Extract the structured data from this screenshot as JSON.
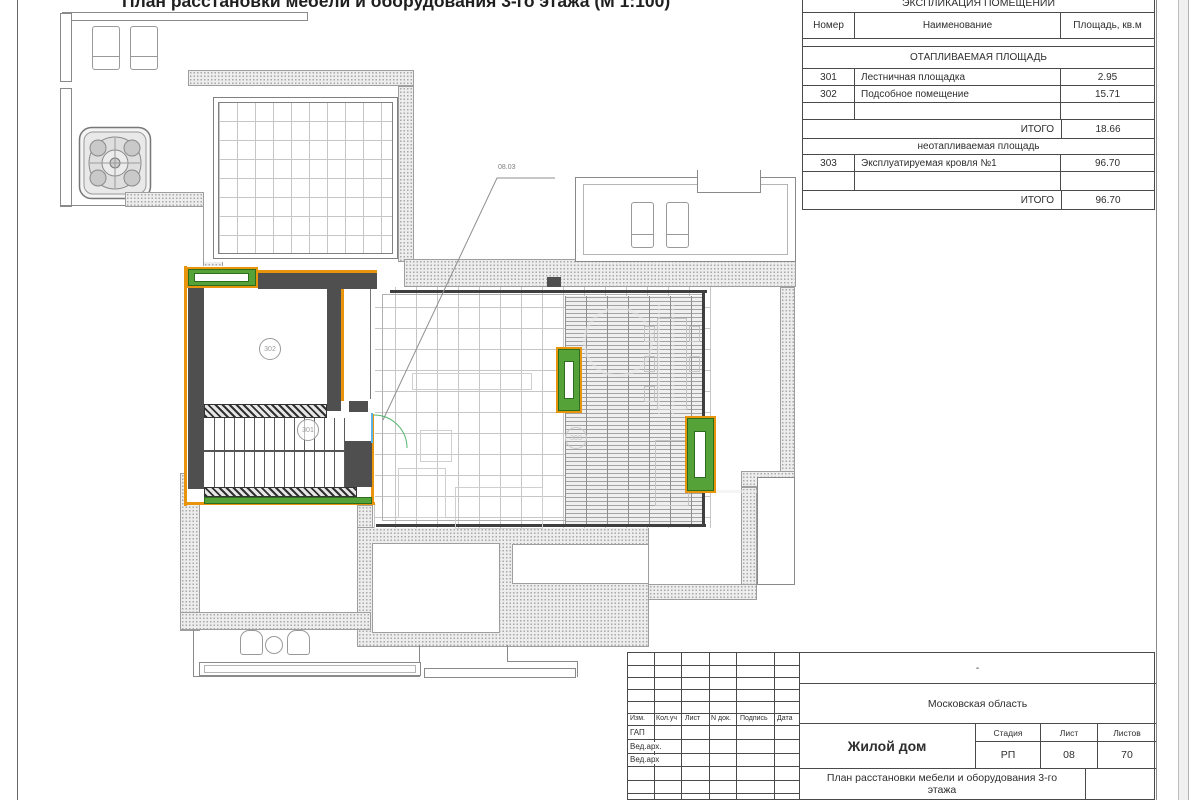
{
  "page": {
    "title": "План расстановки мебели и оборудования 3-го этажа (М 1:100)"
  },
  "explication": {
    "title": "ЭКСПЛИКАЦИЯ ПОМЕЩЕНИЙ",
    "columns": {
      "num": "Номер",
      "name": "Наименование",
      "area": "Площадь, кв.м"
    },
    "section_heated": "ОТАПЛИВАЕМАЯ ПЛОЩАДЬ",
    "rows_heated": [
      {
        "num": "301",
        "name": "Лестничная площадка",
        "area": "2.95"
      },
      {
        "num": "302",
        "name": "Подсобное помещение",
        "area": "15.71"
      }
    ],
    "total_label": "ИТОГО",
    "total_heated": "18.66",
    "section_unheated": "неотапливаемая площадь",
    "rows_unheated": [
      {
        "num": "303",
        "name": "Эксплуатируемая кровля №1",
        "area": "96.70"
      }
    ],
    "total_unheated": "96.70"
  },
  "plan": {
    "room_302": "302",
    "room_301": "301",
    "room_303": "303",
    "callout": "08.03"
  },
  "titleblock": {
    "rev_headers": [
      "Изм.",
      "Кол.уч",
      "Лист",
      "N док.",
      "Подпись",
      "Дата"
    ],
    "roles": [
      "ГАП",
      "Вед.арх.",
      "Вед.арх"
    ],
    "dash": "-",
    "region": "Московская область",
    "project": "Жилой дом",
    "stage_label": "Стадия",
    "sheet_label": "Лист",
    "sheets_label": "Листов",
    "stage": "РП",
    "sheet": "08",
    "sheets": "70",
    "doc_title": "План расстановки мебели и оборудования 3-го этажа"
  },
  "colors": {
    "accent_orange": "#e8940c",
    "accent_green": "#55a338",
    "door_blue": "#5ab4ea",
    "wall_gray": "#4f4f4f"
  }
}
